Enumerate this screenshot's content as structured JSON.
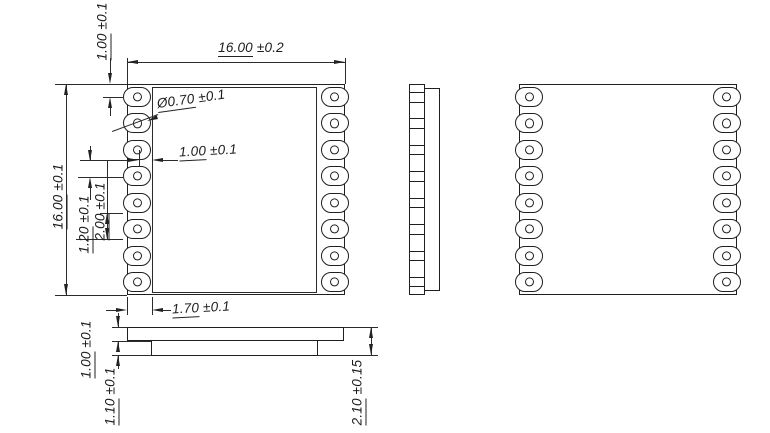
{
  "drawing": {
    "module": {
      "pins_per_side": 8,
      "line_color": "#1f1f1f"
    },
    "views": {
      "top_view": "module-top-view",
      "side_view": "module-side-view",
      "bottom_view": "module-bottom-view",
      "profile_view": "module-profile-view"
    },
    "dimensions": {
      "top_width": {
        "value": "16.00",
        "tol": "±0.2"
      },
      "left_height": {
        "value": "16.00",
        "tol": "±0.1"
      },
      "pin1_offset": {
        "value": "1.00",
        "tol": "±0.1"
      },
      "hole_dia": {
        "value": "Ø0.70",
        "tol": "±0.1"
      },
      "pad_length": {
        "value": "1.00",
        "tol": "±0.1"
      },
      "pad_gap": {
        "value": "1.20",
        "tol": "±0.1"
      },
      "pad_pitch": {
        "value": "2.00",
        "tol": "±0.1"
      },
      "shield_inset": {
        "value": "1.70",
        "tol": "±0.1"
      },
      "pcb_thickness": {
        "value": "1.00",
        "tol": "±0.1"
      },
      "base_thickness": {
        "value": "1.10",
        "tol": "±0.1"
      },
      "total_thickness": {
        "value": "2.10",
        "tol": "±0.15"
      }
    }
  }
}
